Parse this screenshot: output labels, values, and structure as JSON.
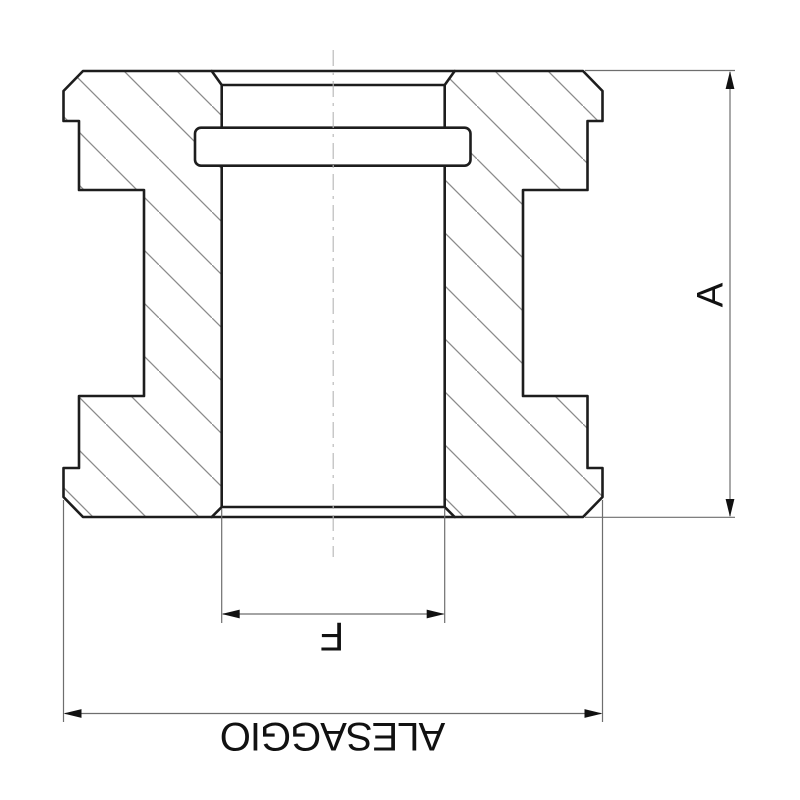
{
  "drawing": {
    "type": "technical-section-drawing",
    "labels": {
      "height_dimension": "A",
      "bore_dimension": "F",
      "overall_width_dimension": "ALESAGGIO"
    },
    "colors": {
      "background": "#ffffff",
      "outline": "#1d1d1d",
      "hatch": "#8a8a8a",
      "dimension": "#6e6e6e",
      "centerline": "#b5b5b5",
      "text": "#111111",
      "fill_white": "#ffffff"
    }
  }
}
